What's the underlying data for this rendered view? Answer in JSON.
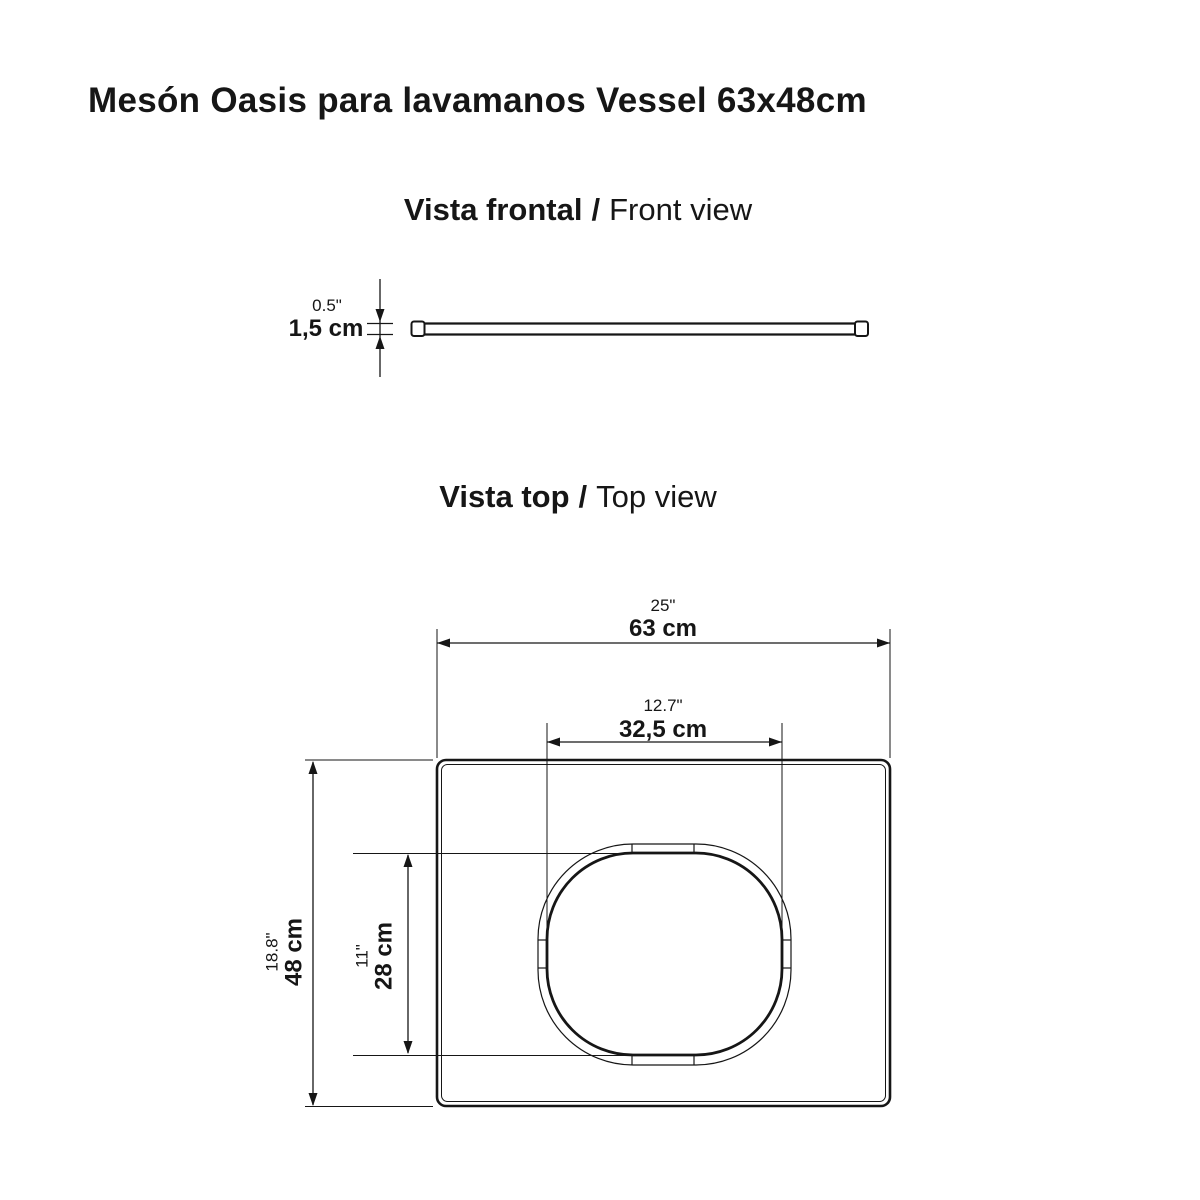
{
  "title": "Mesón Oasis para lavamanos Vessel 63x48cm",
  "colors": {
    "line": "#161616",
    "background": "#ffffff"
  },
  "sections": {
    "front": {
      "label_es": "Vista frontal",
      "separator": "/",
      "label_en": "Front view"
    },
    "top": {
      "label_es": "Vista top",
      "separator": "/",
      "label_en": "Top view"
    }
  },
  "dimensions": {
    "thickness": {
      "inches": "0.5\"",
      "metric": "1,5 cm"
    },
    "overall_width": {
      "inches": "25\"",
      "metric": "63 cm"
    },
    "cutout_width": {
      "inches": "12.7\"",
      "metric": "32,5 cm"
    },
    "overall_depth": {
      "inches": "18.8\"",
      "metric": "48 cm"
    },
    "cutout_depth": {
      "inches": "11\"",
      "metric": "28 cm"
    }
  }
}
